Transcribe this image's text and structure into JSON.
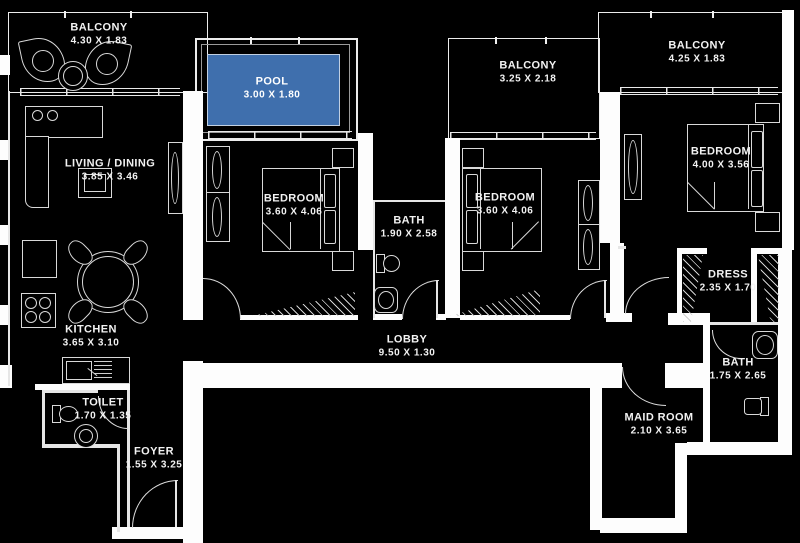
{
  "title": "Apartment Floor Plan",
  "colors": {
    "background": "#000000",
    "wall": "#fdfdfd",
    "line": "#e6e6e6",
    "pool_fill": "#3f6fad",
    "pool_border": "#c2d0e2",
    "text": "#f2f2f2"
  },
  "rooms": {
    "balcony_tl": {
      "label": "BALCONY",
      "dims": "4.30 X 1.83"
    },
    "pool": {
      "label": "POOL",
      "dims": "3.00 X 1.80"
    },
    "balcony_mid": {
      "label": "BALCONY",
      "dims": "3.25 X 2.18"
    },
    "balcony_tr": {
      "label": "BALCONY",
      "dims": "4.25 X 1.83"
    },
    "living_dining": {
      "label": "LIVING / DINING",
      "dims": "3.85 X 3.46"
    },
    "bedroom_1": {
      "label": "BEDROOM",
      "dims": "3.60 X 4.06"
    },
    "bath_1": {
      "label": "BATH",
      "dims": "1.90 X 2.58"
    },
    "bedroom_2": {
      "label": "BEDROOM",
      "dims": "3.60 X 4.06"
    },
    "bedroom_3": {
      "label": "BEDROOM",
      "dims": "4.00 X 3.56"
    },
    "kitchen": {
      "label": "KITCHEN",
      "dims": "3.65 X 3.10"
    },
    "dress": {
      "label": "DRESS",
      "dims": "2.35 X 1.70"
    },
    "lobby": {
      "label": "LOBBY",
      "dims": "9.50 X 1.30"
    },
    "bath_2": {
      "label": "BATH",
      "dims": "1.75 X 2.65"
    },
    "toilet": {
      "label": "TOILET",
      "dims": "1.70 X 1.35"
    },
    "maid_room": {
      "label": "MAID ROOM",
      "dims": "2.10 X 3.65"
    },
    "foyer": {
      "label": "FOYER",
      "dims": "1.55 X 3.25"
    }
  }
}
